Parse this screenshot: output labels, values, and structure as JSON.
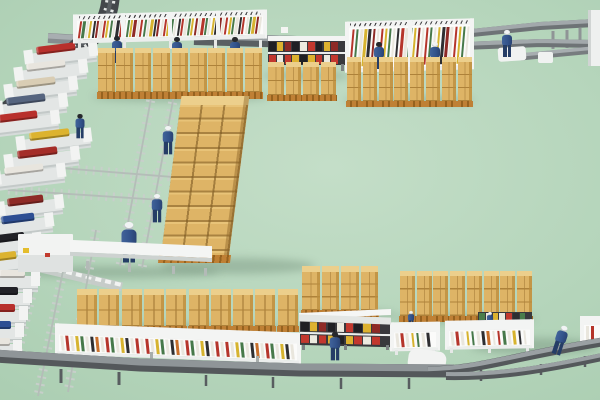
{
  "meta": {
    "description": "3D isometric render of a warehouse production facility: cardboard box pallet stacks, strip sorting shelves, bin shelves, conveyor belts, scaffold catwalks and workers in blue uniforms on a mint green floor",
    "width": 600,
    "height": 400
  },
  "scene": {
    "floor": {
      "from": "#c4dec8",
      "to": "#a9ccb0"
    },
    "box": {
      "top": "#eccf8c",
      "front": "#deb466",
      "line": "#ae823a",
      "side": "#b98c3e",
      "pallet": "#bf8035",
      "palletDark": "#96621f"
    },
    "stripPalette": [
      "#b5352b",
      "#47794a",
      "#e9e6dd",
      "#d6b32f",
      "#2e2e31",
      "#8e2a26",
      "#e9e6dd",
      "#b5352b",
      "#d6b32f",
      "#47794a",
      "#e9e6dd",
      "#2e2e31",
      "#b5352b",
      "#e9e6dd",
      "#47794a",
      "#d6b32f",
      "#8e2a26",
      "#e9e6dd"
    ],
    "stripPaletteB": [
      "#e9e6dd",
      "#b5352b",
      "#e9e6dd",
      "#d6b32f",
      "#47794a",
      "#e9e6dd",
      "#2e2e31",
      "#c9702c",
      "#e9e6dd",
      "#b5352b",
      "#47794a",
      "#e9e6dd",
      "#d6b32f",
      "#2e2e31",
      "#e9e6dd",
      "#b5352b"
    ],
    "binPalette": [
      "#202024",
      "#c2382e",
      "#ddb22f",
      "#eceadf",
      "#8e2a26",
      "#c2382e",
      "#202024",
      "#ddb22f",
      "#eceadf",
      "#202024",
      "#c2382e",
      "#ddb22f"
    ],
    "binPalette2": [
      "#4a7d4c",
      "#c2382e",
      "#eceadf",
      "#2e2e31",
      "#ddb22f",
      "#4a7d4c",
      "#eceadf"
    ],
    "ladders": [
      [
        152,
        93,
        120,
        266
      ],
      [
        174,
        95,
        142,
        268
      ],
      [
        8,
        190,
        162,
        200
      ],
      [
        48,
        167,
        210,
        180
      ],
      [
        44,
        246,
        18,
        352
      ],
      [
        64,
        266,
        38,
        396
      ],
      [
        96,
        230,
        68,
        392
      ]
    ],
    "backPaths": [
      {
        "d": "M 553 31 L 553 49",
        "c": "#8f9496",
        "w": 3
      },
      {
        "d": "M 567 30 L 567 48",
        "c": "#8f9496",
        "w": 3
      },
      {
        "d": "M 580 28 L 580 46",
        "c": "#8f9496",
        "w": 3
      },
      {
        "d": "M 214 42 L 214 56",
        "c": "#7d8285",
        "w": 2
      },
      {
        "d": "M 310 45 L 310 58",
        "c": "#7d8285",
        "w": 2
      },
      {
        "d": "M 395 47 L 395 60",
        "c": "#7d8285",
        "w": 2
      },
      {
        "d": "M 48 38 L 82 40",
        "c": "#868c8f",
        "w": 10
      },
      {
        "d": "M 48 36 L 82 38",
        "c": "#a8aeb1",
        "w": 5
      },
      {
        "d": "M 194 39 L 466 47",
        "c": "#5a5f62",
        "w": 12
      },
      {
        "d": "M 194 36 L 466 44",
        "c": "#9ba1a4",
        "w": 6
      },
      {
        "d": "M 462 34 L 540 26 L 594 23",
        "c": "#6e7376",
        "w": 8
      },
      {
        "d": "M 462 32 L 540 24 L 594 21",
        "c": "#a2a8ab",
        "w": 4
      },
      {
        "d": "M 462 46 L 540 43 L 594 44",
        "c": "#6e7376",
        "w": 8
      },
      {
        "d": "M 462 44 L 540 41 L 594 42",
        "c": "#a2a8ab",
        "w": 4
      },
      {
        "d": "M 520 57 L 594 50",
        "c": "#777c7f",
        "w": 7
      },
      {
        "d": "M 520 55 L 594 48",
        "c": "#a7adb0",
        "w": 3.5
      },
      {
        "d": "M 111 -8 C 110 20 100 34 80 45 L -8 124",
        "c": "#43474b",
        "w": 18
      },
      {
        "d": "M 111 -8 C 110 20 100 34 80 45 L -8 124",
        "c": "#e4e7e6",
        "w": 10,
        "dash": "2.5 6"
      },
      {
        "d": "M 111 -8 C 110 20 100 34 80 45 L -8 124",
        "c": "#595e62",
        "w": 4
      },
      {
        "d": "M -2 258 L 122 287",
        "c": "#c6ccc9",
        "w": 9
      },
      {
        "d": "M -2 256 L 122 285",
        "c": "#f2f3f2",
        "w": 4,
        "dash": "6 4"
      }
    ],
    "frontPaths": [
      {
        "d": "M 61 369 L 61 383",
        "c": "#585d60",
        "w": 3
      },
      {
        "d": "M 119 372 L 119 385",
        "c": "#585d60",
        "w": 3
      },
      {
        "d": "M 206 375 L 206 386",
        "c": "#585d60",
        "w": 2.5
      },
      {
        "d": "M 273 377 L 273 388",
        "c": "#585d60",
        "w": 2.5
      },
      {
        "d": "M 341 378 L 341 389",
        "c": "#585d60",
        "w": 2.5
      },
      {
        "d": "M 409 378 L 409 389",
        "c": "#585d60",
        "w": 2.5
      },
      {
        "d": "M 481 370 L 481 381",
        "c": "#585d60",
        "w": 2.5
      },
      {
        "d": "M 541 364 L 541 375",
        "c": "#585d60",
        "w": 2.5
      },
      {
        "d": "M 585 356 L 585 367",
        "c": "#585d60",
        "w": 2.5
      },
      {
        "d": "M -6 356 L 140 365 L 300 370 L 454 371",
        "c": "#54585b",
        "w": 13
      },
      {
        "d": "M -6 353 L 140 362 L 300 367 L 454 368",
        "c": "#8f9598",
        "w": 7
      },
      {
        "d": "M 428 371 C 480 370 505 358 602 342",
        "c": "#54585b",
        "w": 9
      },
      {
        "d": "M 428 369 C 480 368 505 356 602 340",
        "c": "#9aa0a3",
        "w": 4.5
      },
      {
        "d": "M 446 376 C 500 377 545 369 602 357",
        "c": "#54585b",
        "w": 8
      },
      {
        "d": "M 446 374 C 500 375 545 367 602 355",
        "c": "#9aa0a3",
        "w": 4
      }
    ],
    "machines": [
      [
        26,
        44,
        70,
        "#b8302c"
      ],
      [
        16,
        61,
        70,
        "#e8e5de"
      ],
      [
        6,
        78,
        70,
        "#d9cdb4"
      ],
      [
        -4,
        95,
        70,
        "#56657f"
      ],
      [
        -12,
        112,
        70,
        "#b8302c"
      ],
      [
        18,
        130,
        72,
        "#dcb32f"
      ],
      [
        6,
        148,
        72,
        "#a42d28"
      ],
      [
        -6,
        165,
        70,
        "#e8e5de"
      ],
      [
        -2,
        196,
        64,
        "#8e2a26"
      ],
      [
        -8,
        214,
        60,
        "#2e4f93"
      ],
      [
        -12,
        233,
        52,
        "#222227"
      ],
      [
        -16,
        252,
        46,
        "#dcb32f"
      ],
      [
        -8,
        270,
        46,
        "#e8e5de",
        0
      ],
      [
        -12,
        287,
        42,
        "#222227",
        0
      ],
      [
        -14,
        304,
        40,
        "#b8302c",
        0
      ],
      [
        -16,
        321,
        38,
        "#2e4f93",
        0
      ],
      [
        -16,
        338,
        36,
        "#e8e5de",
        0
      ]
    ],
    "shelves": [
      {
        "x": 75,
        "y": 12,
        "w": 190,
        "headerH": 6,
        "stripH": 19,
        "bottomH": 4,
        "skew": -1.5,
        "lean": -8,
        "stripW": 2.2,
        "gap": 1.2,
        "posts": [
          0,
          0.25,
          0.5,
          0.75,
          1
        ],
        "legs": 5,
        "legH": 9,
        "pal": "A",
        "ticks": true,
        "z": 3
      },
      {
        "x": 347,
        "y": 20,
        "w": 125,
        "headerH": 6,
        "stripH": 41,
        "bottomH": 4,
        "skew": -1.5,
        "lean": -5,
        "stripW": 2.4,
        "gap": 1.7,
        "posts": [
          0,
          0.5,
          1
        ],
        "legs": 3,
        "legH": 13,
        "pal": "A",
        "ticks": true,
        "z": 3
      },
      {
        "x": 57,
        "y": 328,
        "w": 242,
        "headerH": 11,
        "stripH": 17,
        "bottomH": 3,
        "skew": 2.2,
        "lean": 6,
        "stripW": 2.6,
        "gap": 2.4,
        "posts": [
          0,
          1
        ],
        "legs": 0,
        "legH": 0,
        "pal": "B",
        "ticks": false,
        "z": 7
      },
      {
        "x": 392,
        "y": 322,
        "w": 46,
        "headerH": 10,
        "stripH": 16,
        "bottomH": 3,
        "skew": -1,
        "lean": 6,
        "stripW": 2.6,
        "gap": 2.6,
        "posts": [
          0,
          1
        ],
        "legs": 2,
        "legH": 5,
        "pal": "B",
        "ticks": false,
        "z": 7
      },
      {
        "x": 447,
        "y": 320,
        "w": 85,
        "headerH": 10,
        "stripH": 16,
        "bottomH": 3,
        "skew": -1,
        "lean": 6,
        "stripW": 2.6,
        "gap": 2.6,
        "posts": [
          0,
          1
        ],
        "legs": 3,
        "legH": 5,
        "pal": "B",
        "ticks": false,
        "z": 7
      },
      {
        "x": 582,
        "y": 316,
        "w": 20,
        "headerH": 9,
        "stripH": 16,
        "bottomH": 3,
        "skew": 0,
        "lean": 0,
        "stripW": 2.6,
        "gap": 2.4,
        "posts": [
          0
        ],
        "legs": 1,
        "legH": 5,
        "pal": "B",
        "ticks": false,
        "z": 7
      }
    ],
    "binShelves": [
      {
        "x": 268,
        "y": 36,
        "w": 77,
        "rows": 2,
        "rowH": 11,
        "midH": 2,
        "headerH": 5,
        "cellW": 6.5,
        "gap": 1.3,
        "legs": 3,
        "legH": 7,
        "skew": 0,
        "pal": "bin",
        "z": 3
      },
      {
        "x": 300,
        "y": 322,
        "w": 90,
        "rows": 2,
        "rowH": 11,
        "midH": 1.5,
        "headerH": 0,
        "cellW": 7.5,
        "gap": 1.4,
        "legs": 3,
        "legH": 5,
        "skew": 1.5,
        "pal": "bin",
        "z": 7
      },
      {
        "x": 478,
        "y": 312,
        "w": 54,
        "rows": 1,
        "rowH": 9,
        "midH": 0,
        "headerH": 0,
        "cellW": 5.5,
        "gap": 1.3,
        "legs": 0,
        "legH": 0,
        "skew": 0,
        "pal": "bin2",
        "z": 6
      }
    ],
    "stackRows": [
      {
        "x": 98,
        "y": 48,
        "n": 9,
        "pitch": 18.4,
        "w": 16.5,
        "boxH": 13,
        "rows": 3,
        "topH": 5,
        "palH": 7
      },
      {
        "x": 268,
        "y": 62,
        "n": 4,
        "pitch": 17.6,
        "w": 15.5,
        "boxH": 14,
        "rows": 2,
        "topH": 5,
        "palH": 6
      },
      {
        "x": 347,
        "y": 57,
        "n": 8,
        "pitch": 15.8,
        "w": 14,
        "boxH": 13,
        "rows": 3,
        "topH": 5,
        "palH": 6
      },
      {
        "x": 77,
        "y": 289,
        "n": 10,
        "pitch": 22.3,
        "w": 20,
        "boxH": 15.5,
        "rows": 2,
        "topH": 6,
        "palH": 6
      },
      {
        "x": 302,
        "y": 266,
        "n": 4,
        "pitch": 19.6,
        "w": 17.5,
        "boxH": 12.7,
        "rows": 3,
        "topH": 6,
        "palH": 7
      },
      {
        "x": 400,
        "y": 271,
        "n": 8,
        "pitch": 16.7,
        "w": 15,
        "boxH": 13.3,
        "rows": 3,
        "topH": 5,
        "palH": 6
      }
    ],
    "block": {
      "x": 160,
      "y": 96,
      "w": 68,
      "bodyH": 150,
      "topH": 9,
      "palH": 8,
      "skew": -7.3,
      "colW": 22.6,
      "rowH": 14.6
    },
    "rects": [
      {
        "x": 590,
        "y": 10,
        "w": 12,
        "h": 56,
        "bg": "#eef0ef"
      },
      {
        "x": 588,
        "y": 10,
        "w": 2.5,
        "h": 56,
        "bg": "#d0d4d3"
      },
      {
        "x": 538,
        "y": 52,
        "w": 15,
        "h": 11,
        "bg": "#f0f2f1",
        "rx": 2
      },
      {
        "x": 498,
        "y": 47,
        "w": 28,
        "h": 14,
        "bg": "#f0f2f1",
        "rx": 3,
        "rot": -4
      },
      {
        "x": 281,
        "y": 27,
        "w": 7,
        "h": 6,
        "bg": "#f4f5f3",
        "z": 2
      },
      {
        "x": 18,
        "y": 234,
        "w": 55,
        "h": 38,
        "bg": "#f2f3f2",
        "rx": 1
      },
      {
        "x": 18,
        "y": 255,
        "w": 55,
        "h": 17,
        "bg": "#dfe2e1"
      },
      {
        "x": 23,
        "y": 248,
        "w": 6,
        "h": 5,
        "bg": "#e4bd2c"
      },
      {
        "x": 45,
        "y": 253,
        "w": 5,
        "h": 4,
        "bg": "#c23b2e"
      },
      {
        "x": 70,
        "y": 243,
        "w": 142,
        "h": 12,
        "bg": "#f4f5f4",
        "skew": 2.5
      },
      {
        "x": 70,
        "y": 255,
        "w": 142,
        "h": 4,
        "bg": "#cdd2d0",
        "skew": 2.5
      },
      {
        "x": 86,
        "y": 261,
        "w": 3,
        "h": 9,
        "bg": "#b3bab7"
      },
      {
        "x": 128,
        "y": 263,
        "w": 3,
        "h": 9,
        "bg": "#b3bab7"
      },
      {
        "x": 172,
        "y": 266,
        "w": 3,
        "h": 8,
        "bg": "#b3bab7"
      },
      {
        "x": 204,
        "y": 268,
        "w": 3,
        "h": 8,
        "bg": "#b3bab7"
      },
      {
        "x": 408,
        "y": 350,
        "w": 38,
        "h": 22,
        "bg": "#f2f3f2",
        "rx": 8,
        "rot": 8,
        "z": 8
      },
      {
        "x": 299,
        "y": 311,
        "w": 92,
        "h": 6,
        "bg": "#f5f6f5",
        "skew": -2.5,
        "z": 7
      },
      {
        "x": 299,
        "y": 316,
        "w": 92,
        "h": 7,
        "bg": "#e3e6e4",
        "skew": 2,
        "z": 7
      },
      {
        "x": 150,
        "y": 352,
        "w": 3,
        "h": 18,
        "bg": "#a8aeac",
        "z": 7
      },
      {
        "x": 256,
        "y": 356,
        "w": 3,
        "h": 18,
        "bg": "#a8aeac",
        "z": 7
      }
    ],
    "workers": [
      {
        "x": 110,
        "y": 36,
        "t": "hair",
        "s": 1,
        "z": 4
      },
      {
        "x": 170,
        "y": 37,
        "t": "hair",
        "s": 1,
        "z": 4
      },
      {
        "x": 228,
        "y": 37,
        "t": "hair",
        "s": 1,
        "z": 4
      },
      {
        "x": 372,
        "y": 42,
        "t": "hair",
        "s": 1,
        "z": 4
      },
      {
        "x": 428,
        "y": 42,
        "t": "helmet",
        "s": 1,
        "z": 4
      },
      {
        "x": 500,
        "y": 30,
        "t": "helmet",
        "s": 1,
        "z": 9
      },
      {
        "x": 161,
        "y": 126,
        "t": "helmet",
        "s": 1.05,
        "z": 9
      },
      {
        "x": 150,
        "y": 194,
        "t": "helmet",
        "s": 1.05,
        "z": 9
      },
      {
        "x": 122,
        "y": 222,
        "t": "helmet",
        "s": 1.5,
        "z": 5
      },
      {
        "x": 328,
        "y": 332,
        "t": "hair",
        "s": 1.05,
        "z": 9
      },
      {
        "x": 404,
        "y": 311,
        "t": "helmet",
        "s": 0.62,
        "z": 6
      },
      {
        "x": 483,
        "y": 312,
        "t": "helmet",
        "s": 0.62,
        "z": 6
      },
      {
        "x": 558,
        "y": 326,
        "t": "helmet",
        "s": 1.1,
        "r": 18,
        "z": 9
      },
      {
        "x": 73,
        "y": 114,
        "t": "hair",
        "s": 0.9,
        "z": 9
      }
    ],
    "shadows": [
      [
        160,
        258,
        155,
        16
      ],
      [
        92,
        92,
        178,
        10
      ],
      [
        72,
        324,
        235,
        10
      ],
      [
        296,
        310,
        100,
        9
      ],
      [
        394,
        314,
        142,
        9
      ],
      [
        343,
        96,
        132,
        9
      ],
      [
        262,
        72,
        88,
        8
      ],
      [
        14,
        266,
        205,
        12
      ],
      [
        470,
        338,
        130,
        16
      ]
    ],
    "workerColors": {
      "torso1": "#41639a",
      "torso2": "#32528a",
      "torso3": "#2a4373",
      "legs": "#253d66",
      "hair": "#26282c",
      "helmet": "#f1f3f4"
    }
  }
}
